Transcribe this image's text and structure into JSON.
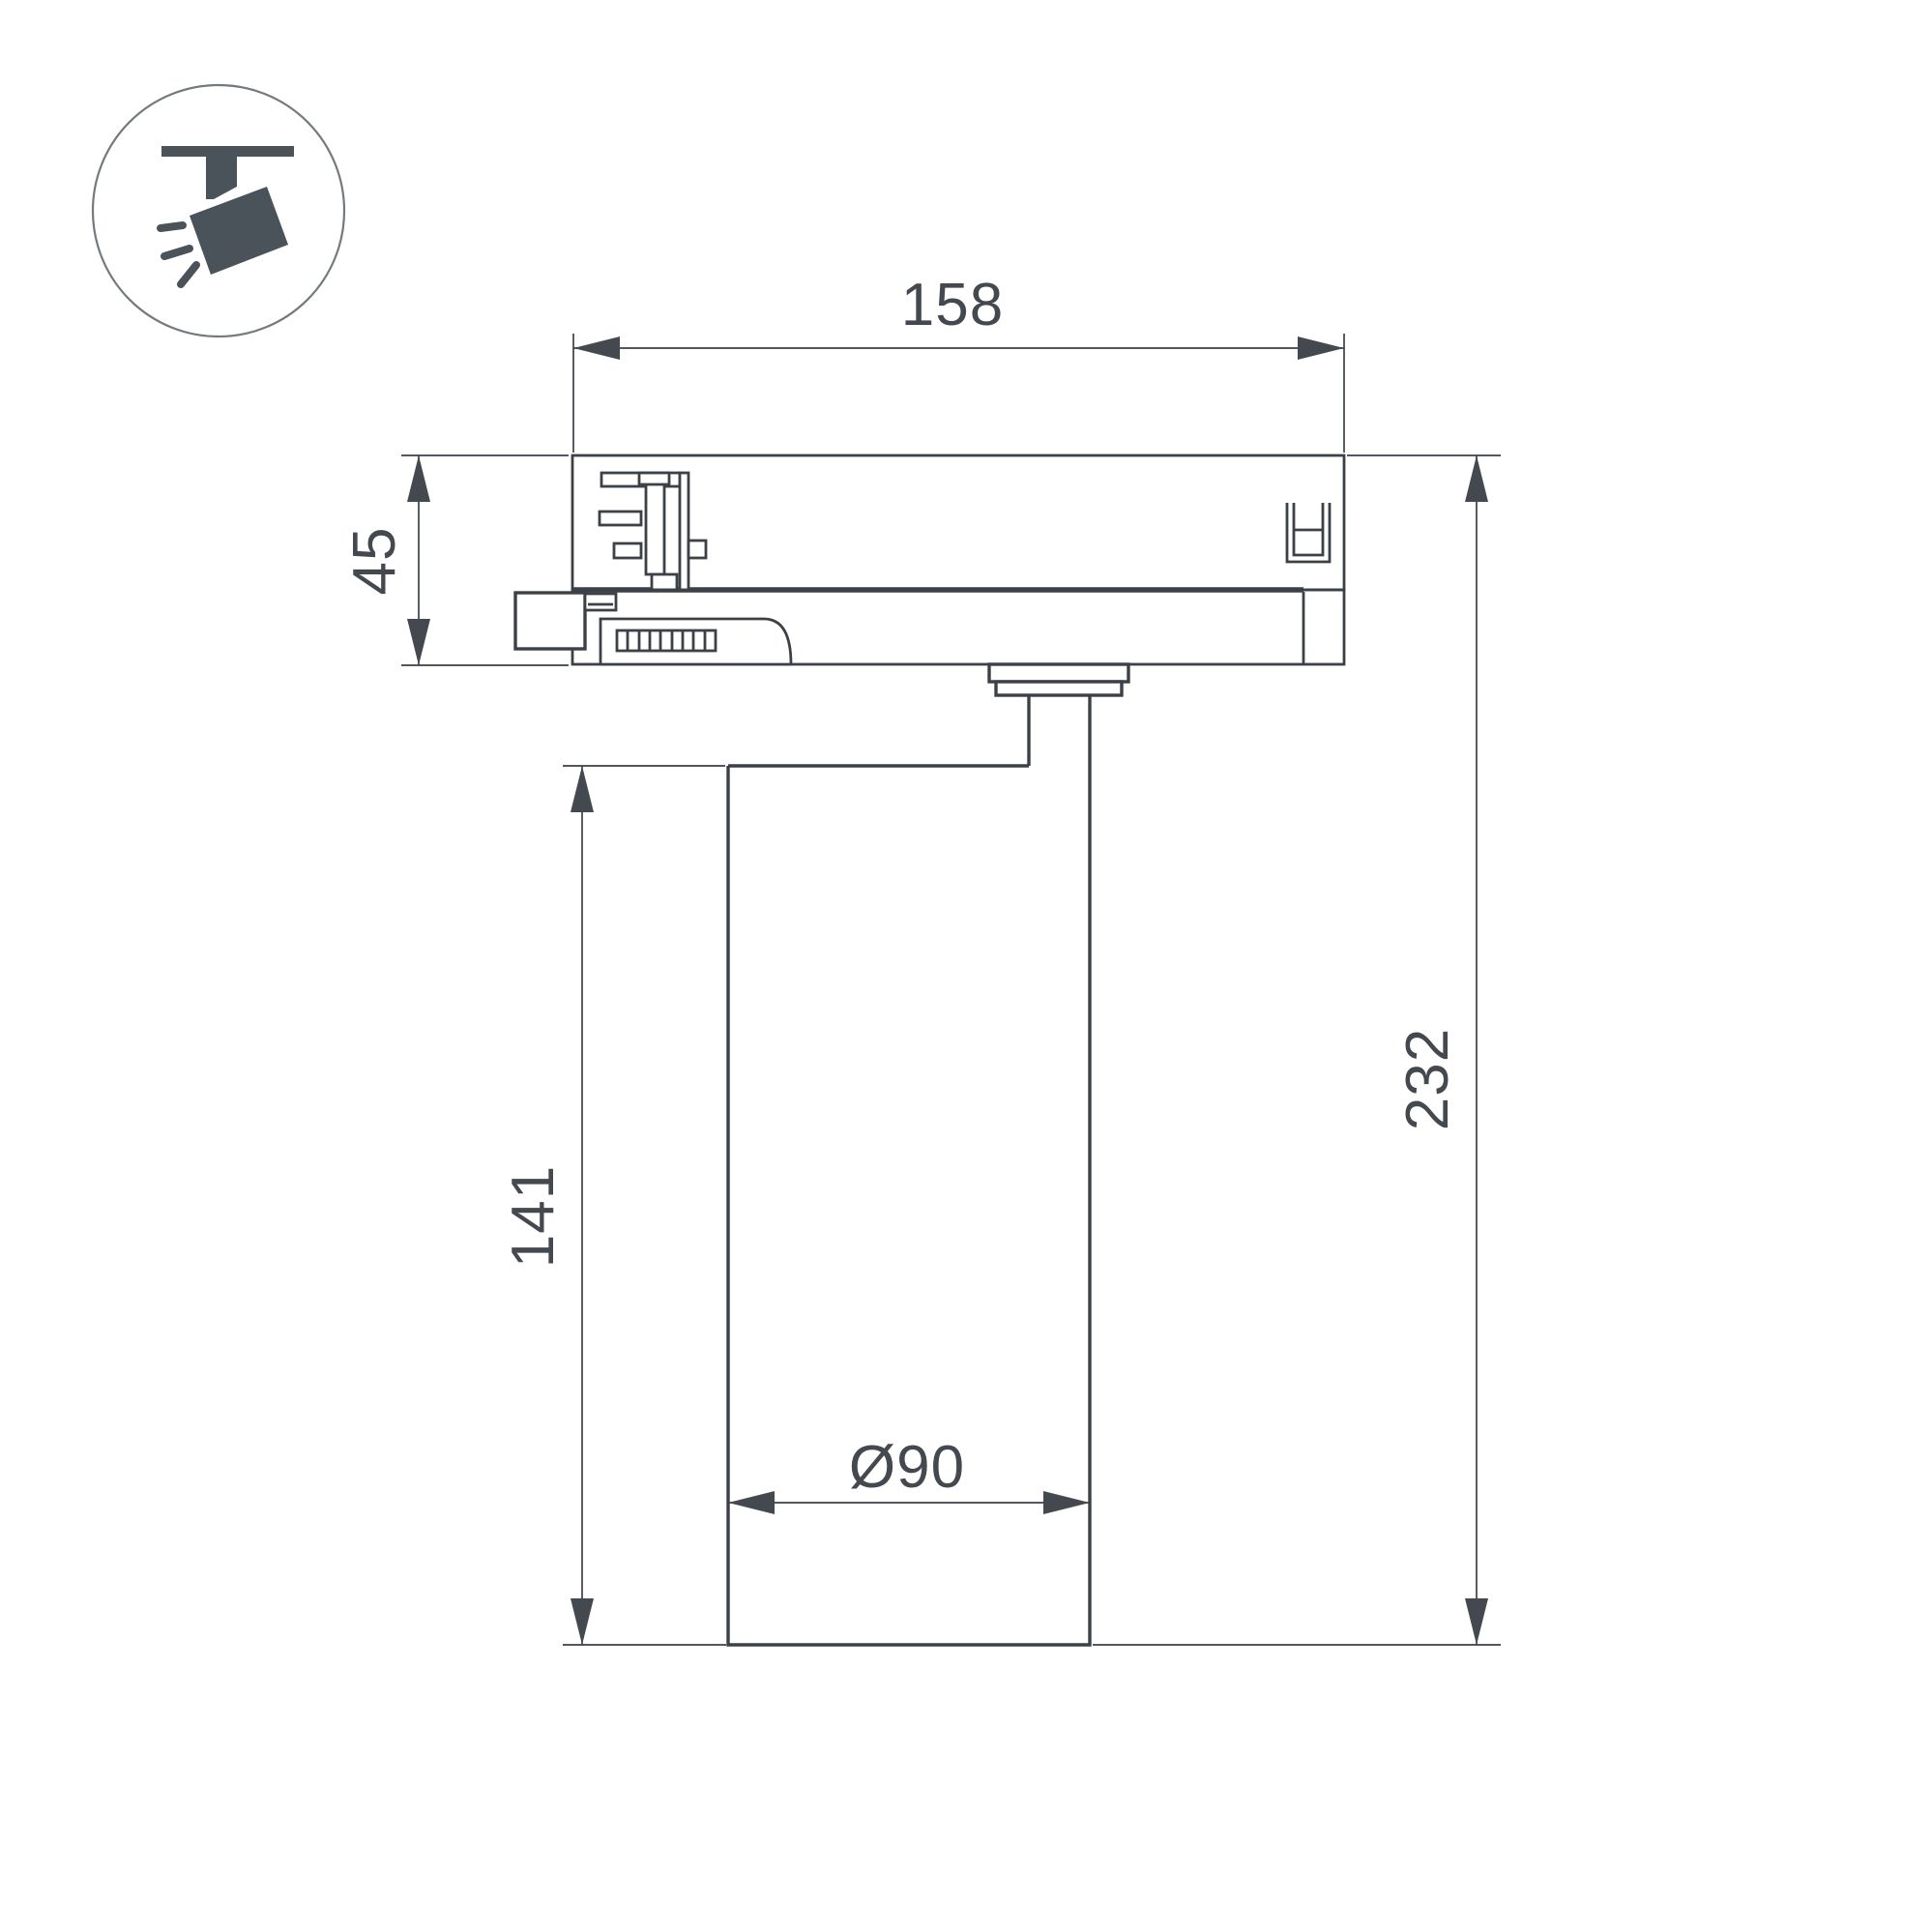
{
  "icon": {
    "name": "track-spotlight-icon"
  },
  "drawing": {
    "labels": {
      "adapter_width": "158",
      "adapter_height": "45",
      "body_height": "141",
      "overall_height": "232",
      "body_diameter": "Ø90"
    },
    "colors": {
      "line": "#3c4147",
      "text": "#44494f",
      "icon_fill": "#4a525a",
      "circle_stroke": "#74797f",
      "background": "#ffffff"
    }
  }
}
